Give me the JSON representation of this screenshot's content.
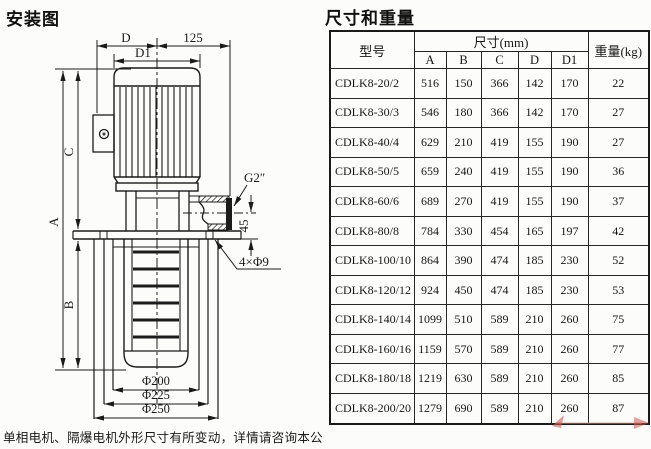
{
  "page": {
    "left_title": "安装图",
    "right_title": "尺寸和重量",
    "footnote": "单相电机、隔爆电机外形尺寸有所变动，详情请咨询本公司。"
  },
  "diagram": {
    "line_color": "#1b1b1b",
    "labels": {
      "dim_d": "D",
      "dim_125": "125",
      "dim_d1": "D1",
      "dim_a": "A",
      "dim_b": "B",
      "dim_c": "C",
      "dim_45": "45",
      "port_thread": "G2″",
      "bolt_holes": "4×Φ9",
      "dia_200": "Φ200",
      "dia_225": "Φ225",
      "dia_250": "Φ250"
    }
  },
  "table": {
    "header": {
      "model": "型号",
      "dims_group": "尺寸(mm)",
      "dim_cols": [
        "A",
        "B",
        "C",
        "D",
        "D1"
      ],
      "weight": "重量(kg)"
    },
    "rows": [
      [
        "CDLK8-20/2",
        "516",
        "150",
        "366",
        "142",
        "170",
        "22"
      ],
      [
        "CDLK8-30/3",
        "546",
        "180",
        "366",
        "142",
        "170",
        "27"
      ],
      [
        "CDLK8-40/4",
        "629",
        "210",
        "419",
        "155",
        "190",
        "27"
      ],
      [
        "CDLK8-50/5",
        "659",
        "240",
        "419",
        "155",
        "190",
        "36"
      ],
      [
        "CDLK8-60/6",
        "689",
        "270",
        "419",
        "155",
        "190",
        "37"
      ],
      [
        "CDLK8-80/8",
        "784",
        "330",
        "454",
        "165",
        "197",
        "42"
      ],
      [
        "CDLK8-100/10",
        "864",
        "390",
        "474",
        "185",
        "230",
        "52"
      ],
      [
        "CDLK8-120/12",
        "924",
        "450",
        "474",
        "185",
        "230",
        "53"
      ],
      [
        "CDLK8-140/14",
        "1099",
        "510",
        "589",
        "210",
        "260",
        "75"
      ],
      [
        "CDLK8-160/16",
        "1159",
        "570",
        "589",
        "210",
        "260",
        "77"
      ],
      [
        "CDLK8-180/18",
        "1219",
        "630",
        "589",
        "210",
        "260",
        "85"
      ],
      [
        "CDLK8-200/20",
        "1279",
        "690",
        "589",
        "210",
        "260",
        "87"
      ]
    ]
  },
  "watermark": {
    "accent_color": "#cc5a52"
  }
}
